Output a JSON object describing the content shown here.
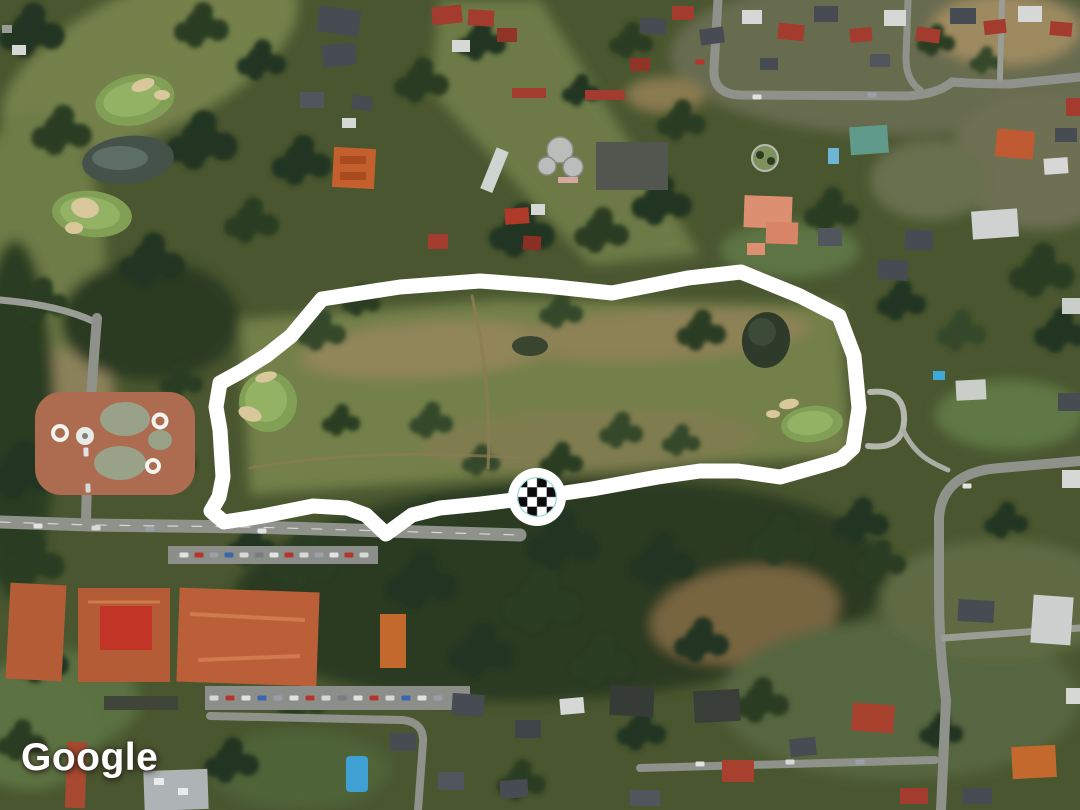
{
  "map": {
    "attribution_text": "Google",
    "imagery_type": "satellite"
  },
  "route": {
    "color": "#ffffff",
    "stroke_width": 15,
    "points": [
      [
        322,
        299
      ],
      [
        400,
        287
      ],
      [
        480,
        281
      ],
      [
        546,
        286
      ],
      [
        612,
        293
      ],
      [
        688,
        278
      ],
      [
        741,
        272
      ],
      [
        800,
        296
      ],
      [
        839,
        316
      ],
      [
        854,
        356
      ],
      [
        859,
        408
      ],
      [
        853,
        448
      ],
      [
        841,
        459
      ],
      [
        826,
        464
      ],
      [
        780,
        477
      ],
      [
        738,
        471
      ],
      [
        700,
        471
      ],
      [
        658,
        477
      ],
      [
        592,
        489
      ],
      [
        537,
        497
      ],
      [
        481,
        504
      ],
      [
        440,
        508
      ],
      [
        412,
        515
      ],
      [
        386,
        534
      ],
      [
        366,
        515
      ],
      [
        347,
        508
      ],
      [
        313,
        506
      ],
      [
        263,
        516
      ],
      [
        224,
        522
      ],
      [
        211,
        511
      ],
      [
        219,
        497
      ],
      [
        223,
        477
      ],
      [
        220,
        430
      ],
      [
        216,
        407
      ],
      [
        220,
        383
      ],
      [
        240,
        372
      ],
      [
        267,
        355
      ],
      [
        291,
        336
      ],
      [
        322,
        299
      ]
    ],
    "marker": {
      "type": "checkered-flag",
      "x": 537,
      "y": 497,
      "outer_radius": 29,
      "checker_radius": 19.4,
      "checker_square": 9.7,
      "ring_color": "#9ed9d2",
      "checker_dark": "#0c0c0c",
      "checker_light": "#ffffff"
    }
  }
}
